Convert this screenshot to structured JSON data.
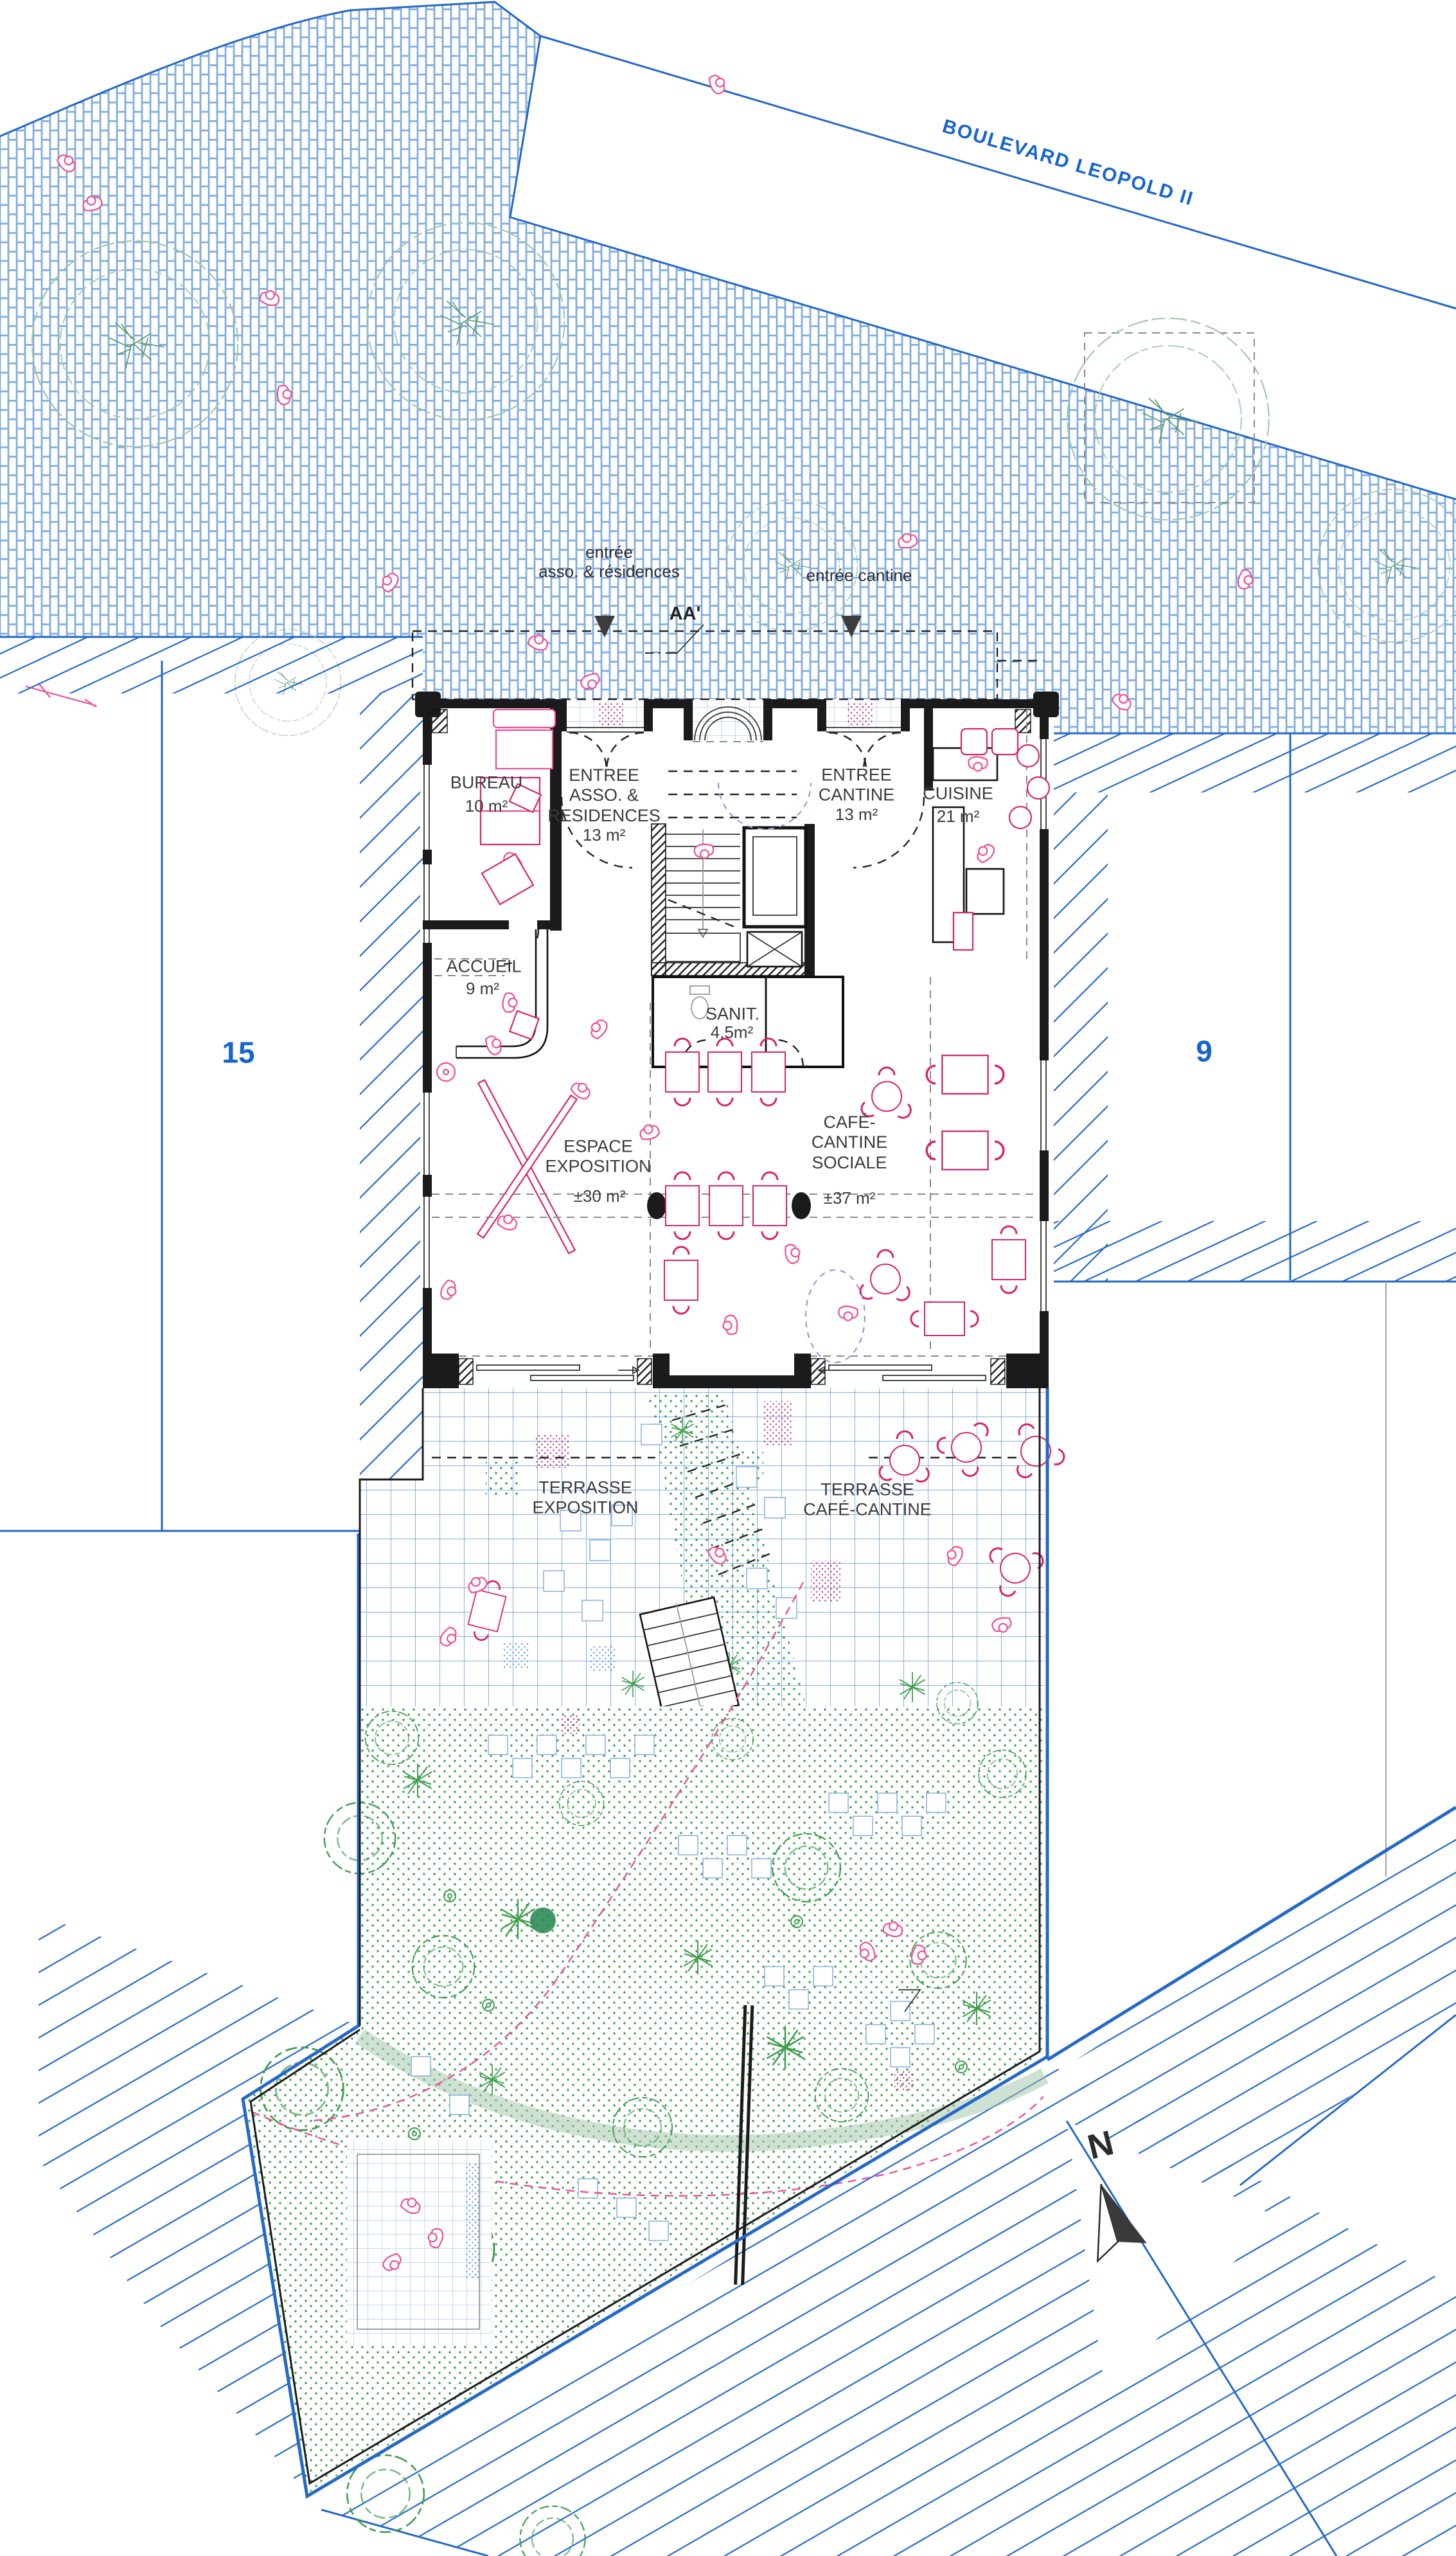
{
  "street": {
    "name": "BOULEVARD LEOPOLD II"
  },
  "annotations": {
    "entrance_asso": "entrée\nasso. & résidences",
    "entrance_cantine": "entrée cantine",
    "section_mark": "AA'",
    "north": "N"
  },
  "parcels": {
    "left": "15",
    "right": "9"
  },
  "rooms": [
    {
      "id": "bureau",
      "name": "BUREAU",
      "area": "10 m²"
    },
    {
      "id": "entree-asso",
      "name": "ENTREE\nASSO. &\nRESIDENCES",
      "area": "13 m²"
    },
    {
      "id": "entree-cantine",
      "name": "ENTREE\nCANTINE",
      "area": "13 m²"
    },
    {
      "id": "cuisine",
      "name": "CUISINE",
      "area": "21 m²"
    },
    {
      "id": "accueil",
      "name": "ACCUEIL",
      "area": "9 m²"
    },
    {
      "id": "sanitaires",
      "name": "SANIT.",
      "area": "4,5m²"
    },
    {
      "id": "espace-exposition",
      "name": "ESPACE\nEXPOSITION",
      "area": "±30 m²"
    },
    {
      "id": "cafe-cantine-sociale",
      "name": "CAFÉ-\nCANTINE\nSOCIALE",
      "area": "±37 m²"
    }
  ],
  "terraces": [
    {
      "name": "TERRASSE\nEXPOSITION"
    },
    {
      "name": "TERRASSE\nCAFÉ-CANTINE"
    }
  ],
  "colors": {
    "blue": "#2468c9",
    "bluepale": "#7aa7dc",
    "bluegrid": "#5b95dd",
    "bluetext": "#1565d0",
    "pink": "#ed4d96",
    "crimson": "#d6246e",
    "green": "#3f9e4d",
    "sage": "#9fc4a8",
    "greendark": "#2e8b57",
    "ink": "#1b1b1b",
    "purple": "#a98fdc"
  }
}
